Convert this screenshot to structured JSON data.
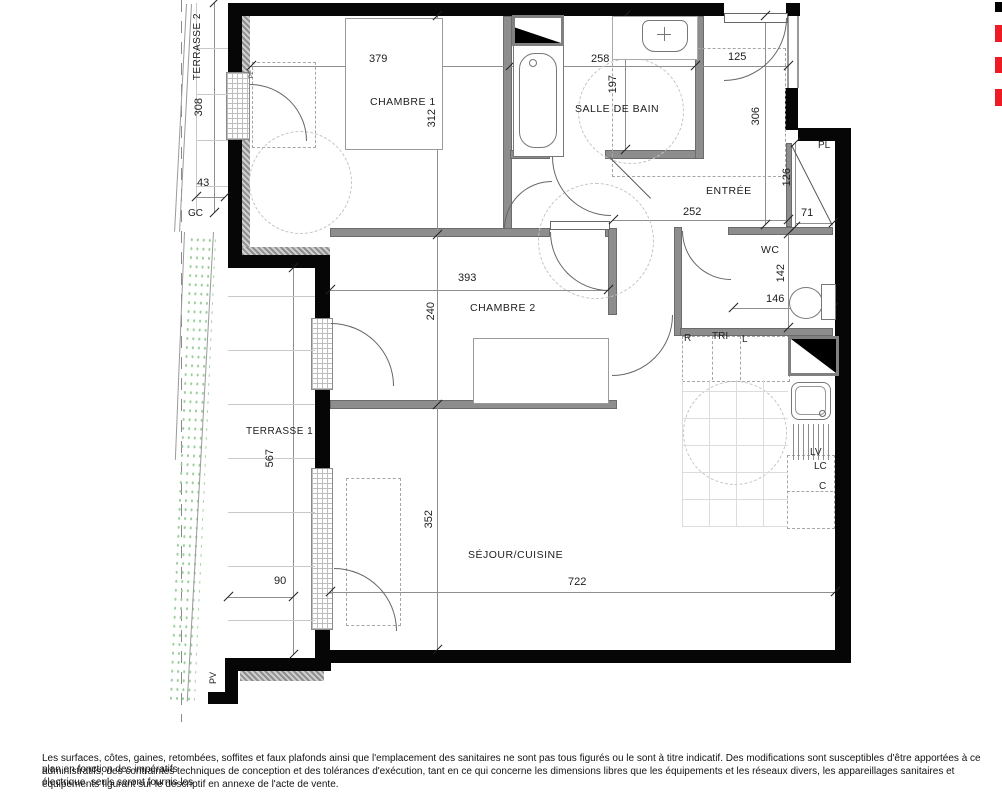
{
  "plan": {
    "rooms": {
      "chambre1": {
        "label": "CHAMBRE 1",
        "width_cm": "379",
        "depth_cm": "312"
      },
      "salle_de_bain": {
        "label": "SALLE DE BAIN",
        "width_cm": "258",
        "depth_cm": "197"
      },
      "entree": {
        "label": "ENTRÉE",
        "width_cm": "252",
        "depth_cm": "306",
        "door_width_cm": "125"
      },
      "placard": {
        "label": "PL",
        "depth_cm": "126",
        "width_cm": "71"
      },
      "wc": {
        "label": "WC",
        "depth_cm": "142",
        "width_cm": "146"
      },
      "chambre2": {
        "label": "CHAMBRE 2",
        "width_cm": "393",
        "depth_cm": "240"
      },
      "sejour_cuisine": {
        "label": "SÉJOUR/CUISINE",
        "width_cm": "722",
        "depth_cm": "352"
      },
      "terrasse1": {
        "label": "TERRASSE 1",
        "length_cm": "567",
        "width_cm": "90"
      },
      "terrasse2": {
        "label": "TERRASSE 2",
        "length_cm": "308",
        "width_cm": "43"
      }
    },
    "annotations": {
      "gc": "GC",
      "pv": "PV",
      "pf": "PF",
      "r": "R",
      "tri": "TRI",
      "l": "L",
      "lv": "LV",
      "lc": "LC",
      "c": "C"
    }
  },
  "colors": {
    "wall_black": "#000000",
    "accent_red": "#ec1b24",
    "partition_gray": "#8d8d8d",
    "terrace_green": "#9ccf9c"
  },
  "footer": {
    "line1": "Les surfaces, côtes, gaines, retombées, soffites et faux plafonds ainsi que l'emplacement des sanitaires ne sont pas tous figurés ou le sont à titre indicatif. Des modifications sont susceptibles d'être apportées à ce plan en fonction des impératifs",
    "line2": "administratifs, des contraintes techniques de conception et des tolérances d'exécution, tant en ce qui concerne les dimensions libres que les équipements et les réseaux divers, les appareillages sanitaires et électrique. seuls seront fournis les",
    "line3": "équipements figurant sur le descriptif en annexe de l'acte de vente."
  }
}
